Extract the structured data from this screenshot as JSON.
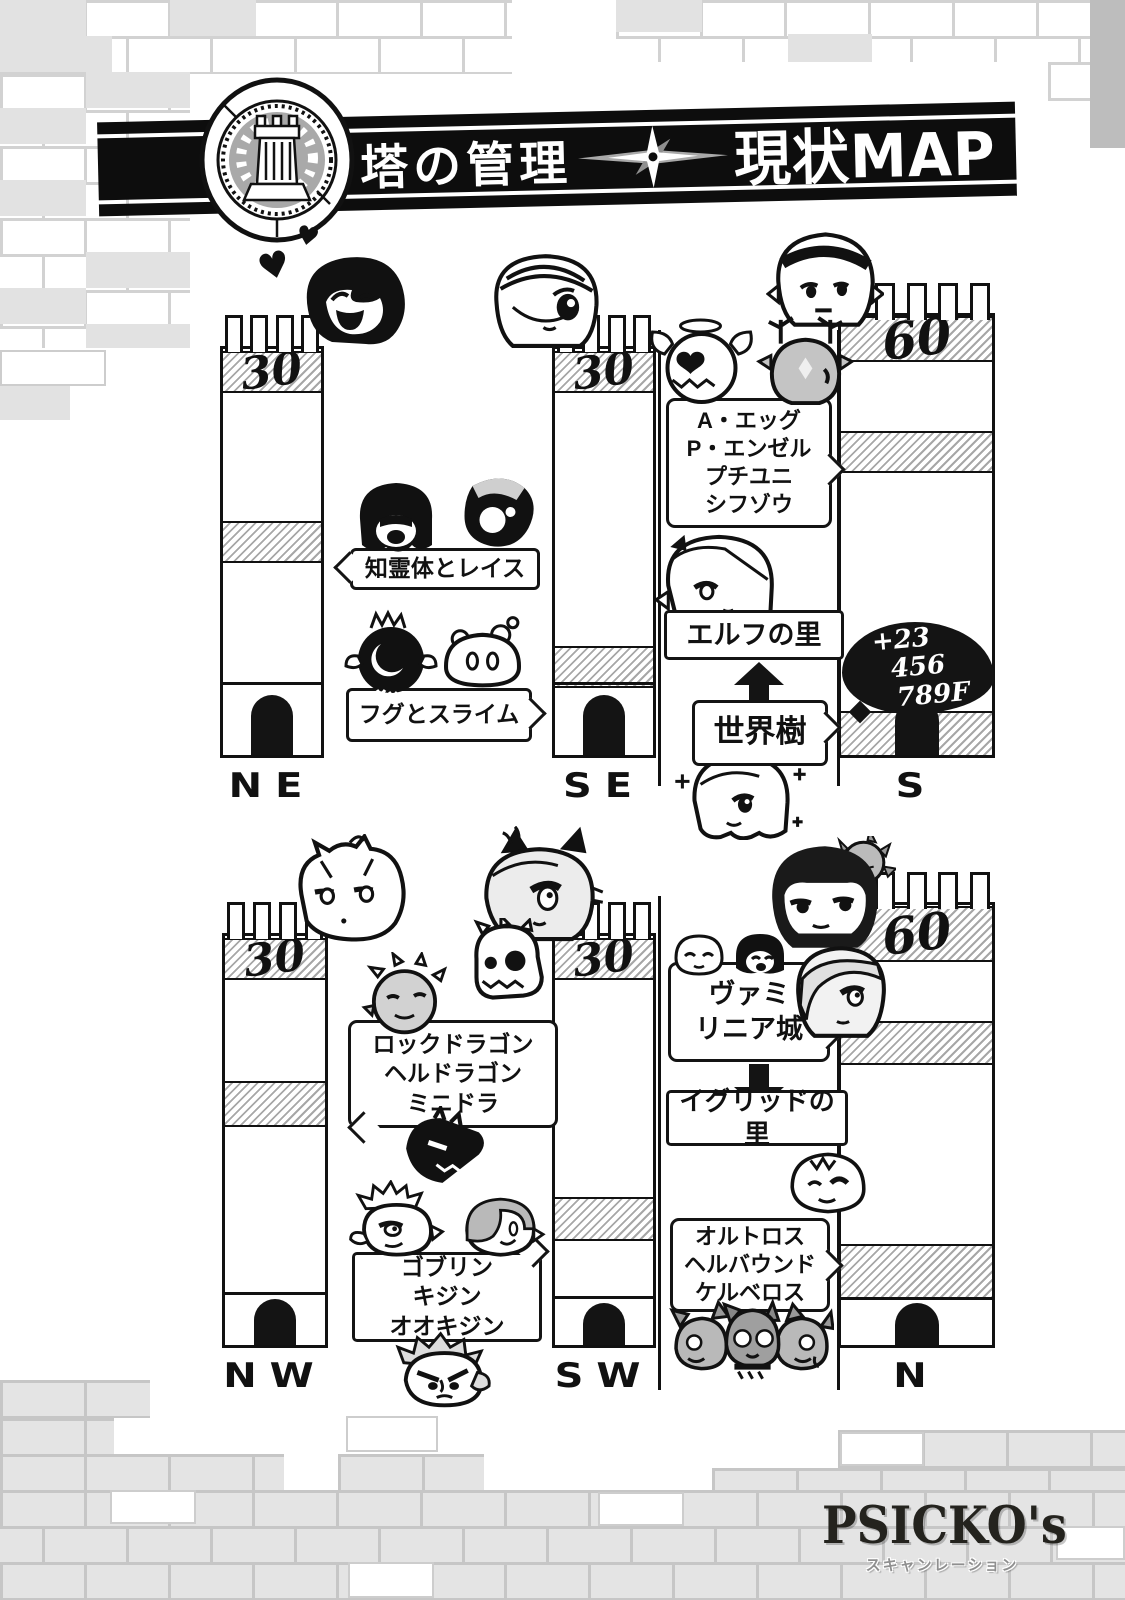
{
  "header": {
    "emblem": "tower-crest",
    "title": "塔の管理",
    "map_title": "現状MAP"
  },
  "towers": [
    {
      "direction": "NE",
      "floor": "30"
    },
    {
      "direction": "SE",
      "floor": "30"
    },
    {
      "direction": "S",
      "floor": "60"
    },
    {
      "direction": "NW",
      "floor": "30"
    },
    {
      "direction": "SW",
      "floor": "30"
    },
    {
      "direction": "N",
      "floor": "60"
    }
  ],
  "notes": {
    "spirits": "知霊体とレイス",
    "fugu_slime": "フグとスライム",
    "egg_group": [
      "A・エッグ",
      "P・エンゼル",
      "プチユニ",
      "シフゾウ"
    ],
    "elf_village": "エルフの里",
    "world_tree": "世界樹",
    "floor_count": [
      "+23",
      "456",
      "789F"
    ],
    "dragons": [
      "ロックドラゴン",
      "ヘルドラゴン",
      "ミニドラ"
    ],
    "vamilinia": [
      "ヴァミ",
      "リニア城"
    ],
    "igrid_village": "イグリッドの里",
    "goblins": [
      "ゴブリン",
      "キジン",
      "オオキジン"
    ],
    "hounds": [
      "オルトロス",
      "ヘルバウンド",
      "ケルベロス"
    ]
  },
  "credit": {
    "group": "PSICKO's",
    "label": "スキャンレーション"
  },
  "colors": {
    "ink": "#111111",
    "paper": "#ffffff",
    "tone": "#a7a7a7",
    "brick_gray": "#e4e4e4",
    "brick_line": "#c9c9c9"
  }
}
